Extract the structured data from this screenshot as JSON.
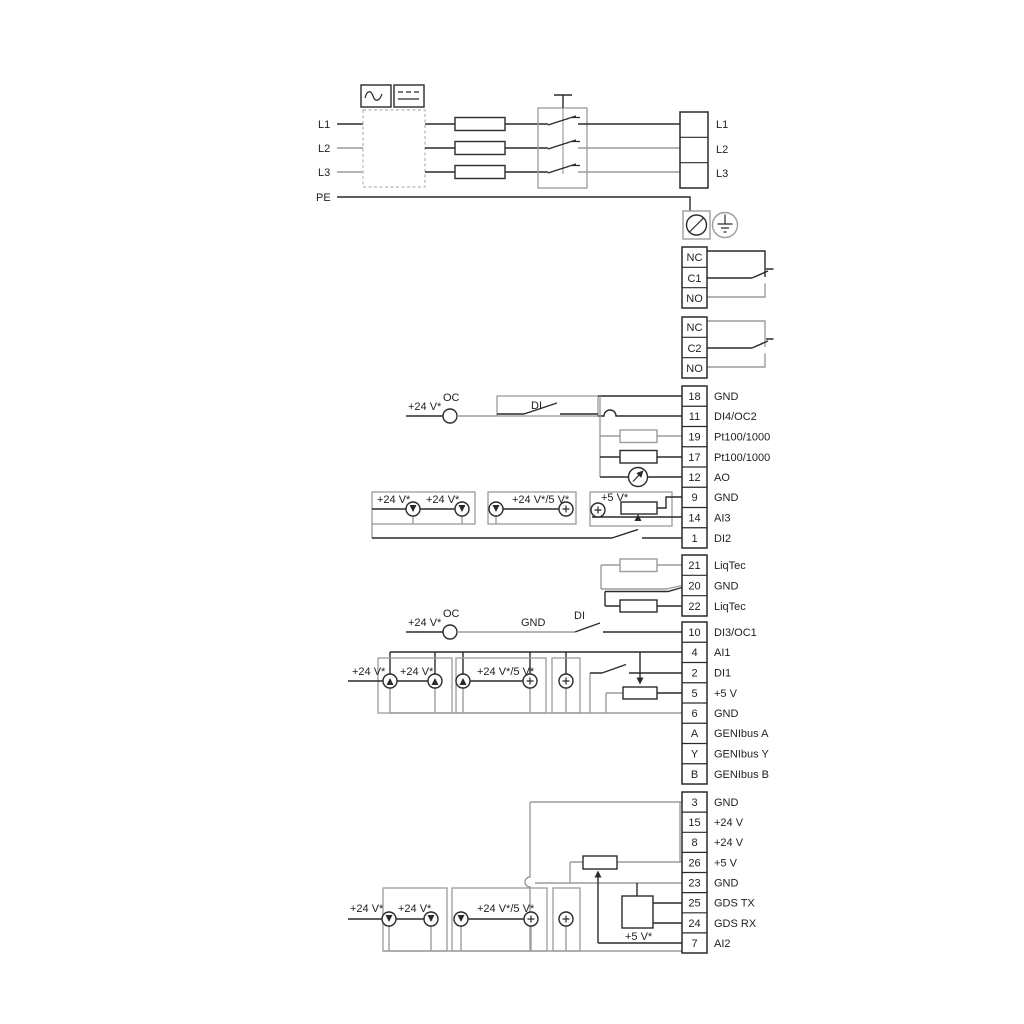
{
  "colors": {
    "line_black": "#2a2a2a",
    "line_gray": "#9c9c9c",
    "text": "#1f1f1f"
  },
  "power_in": {
    "l1": "L1",
    "l2": "L2",
    "l3": "L3",
    "pe": "PE"
  },
  "power_out": {
    "l1": "L1",
    "l2": "L2",
    "l3": "L3"
  },
  "relay1": {
    "nc": "NC",
    "com": "C1",
    "no": "NO"
  },
  "relay2": {
    "nc": "NC",
    "com": "C2",
    "no": "NO"
  },
  "tb1": {
    "rows": [
      {
        "n": "18",
        "l": "GND"
      },
      {
        "n": "11",
        "l": "DI4/OC2"
      },
      {
        "n": "19",
        "l": "Pt100/1000"
      },
      {
        "n": "17",
        "l": "Pt100/1000"
      },
      {
        "n": "12",
        "l": "AO"
      },
      {
        "n": "9",
        "l": "GND"
      },
      {
        "n": "14",
        "l": "AI3"
      },
      {
        "n": "1",
        "l": "DI2"
      }
    ]
  },
  "tb2": {
    "rows": [
      {
        "n": "21",
        "l": "LiqTec"
      },
      {
        "n": "20",
        "l": "GND"
      },
      {
        "n": "22",
        "l": "LiqTec"
      }
    ]
  },
  "tb3": {
    "rows": [
      {
        "n": "10",
        "l": "DI3/OC1"
      },
      {
        "n": "4",
        "l": "AI1"
      },
      {
        "n": "2",
        "l": "DI1"
      },
      {
        "n": "5",
        "l": "+5 V"
      },
      {
        "n": "6",
        "l": "GND"
      },
      {
        "n": "A",
        "l": "GENIbus A"
      },
      {
        "n": "Y",
        "l": "GENIbus Y"
      },
      {
        "n": "B",
        "l": "GENIbus B"
      }
    ]
  },
  "tb4": {
    "rows": [
      {
        "n": "3",
        "l": "GND"
      },
      {
        "n": "15",
        "l": "+24 V"
      },
      {
        "n": "8",
        "l": "+24 V"
      },
      {
        "n": "26",
        "l": "+5 V"
      },
      {
        "n": "23",
        "l": "GND"
      },
      {
        "n": "25",
        "l": "GDS TX"
      },
      {
        "n": "24",
        "l": "GDS RX"
      },
      {
        "n": "7",
        "l": "AI2"
      }
    ]
  },
  "di4_row": {
    "v24": "+24 V*",
    "oc": "OC",
    "di": "DI"
  },
  "ai3_row": {
    "v24_a": "+24 V*",
    "v24_b": "+24 V*",
    "v24_5": "+24 V*/5 V*",
    "v5": "+5 V*"
  },
  "di3_row": {
    "v24": "+24 V*",
    "oc": "OC",
    "gnd": "GND",
    "di": "DI"
  },
  "ai1_row": {
    "v24_a": "+24 V*",
    "v24_b": "+24 V*",
    "v24_5": "+24 V*/5 V*"
  },
  "ai2_row": {
    "v24_a": "+24 V*",
    "v24_b": "+24 V*",
    "v24_5": "+24 V*/5 V*",
    "v5": "+5 V*"
  }
}
